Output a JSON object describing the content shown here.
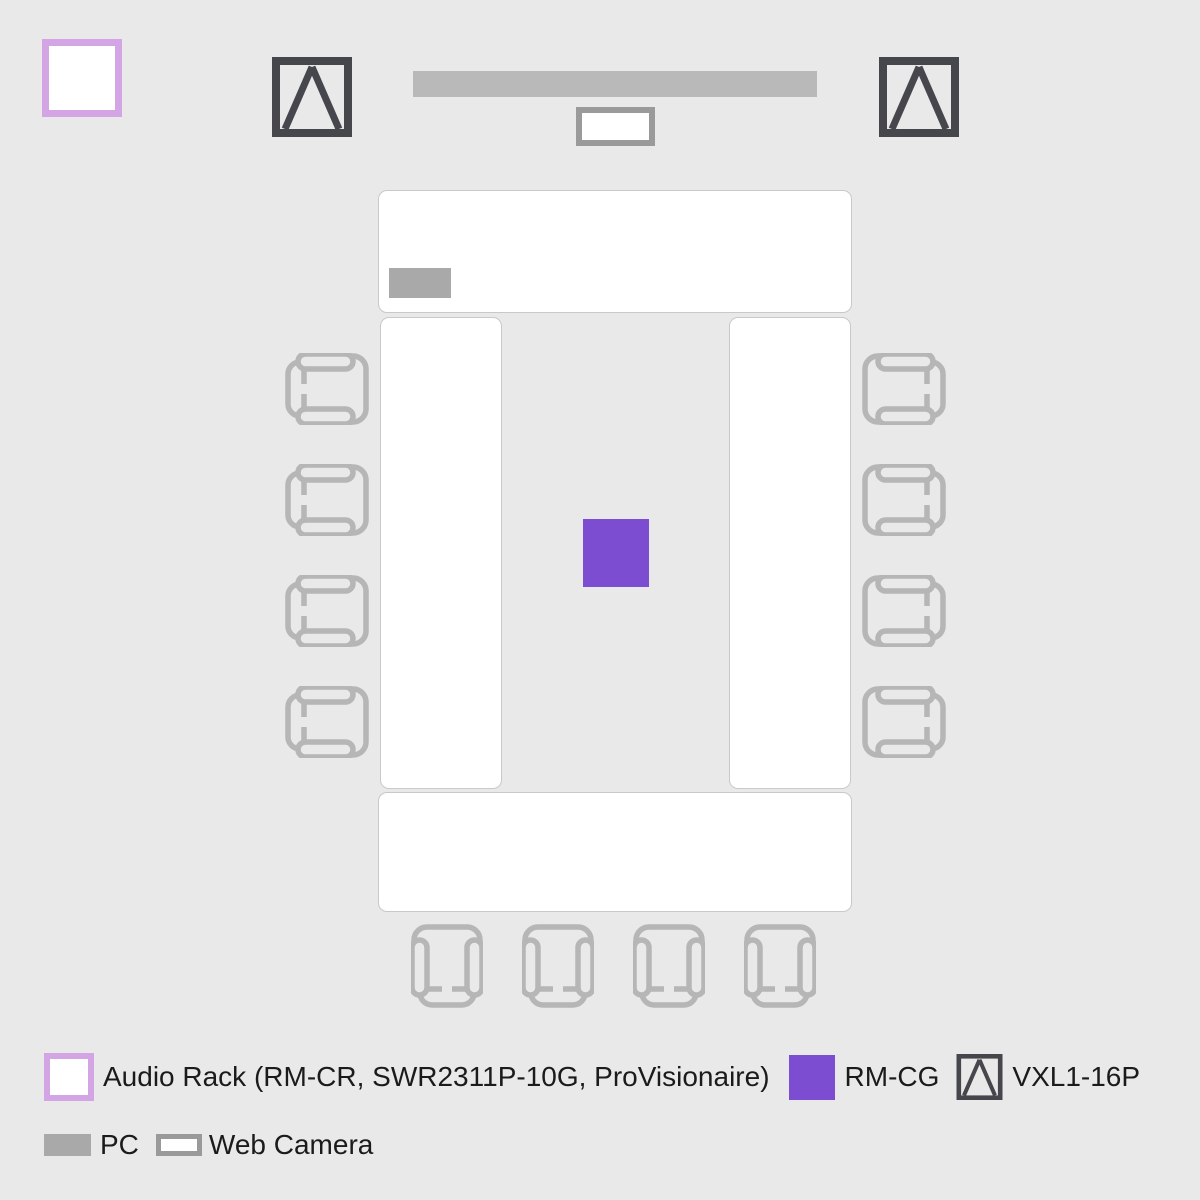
{
  "legend": {
    "audio_rack": "Audio Rack (RM-CR, SWR2311P-10G, ProVisionaire)",
    "rm_cg": "RM-CG",
    "vxl": "VXL1-16P",
    "pc": "PC",
    "web_camera": "Web Camera"
  },
  "colors": {
    "background": "#e9e9e9",
    "table_fill": "#ffffff",
    "table_border": "#c9c9c9",
    "chair_stroke": "#b6b6b6",
    "display_bar": "#b9b9b9",
    "pc_fill": "#a9a9a9",
    "web_camera_border": "#9a9a9a",
    "rm_cg_purple": "#7c4dd1",
    "audio_rack_border": "#d4a5e5",
    "vxl_dark": "#45474c",
    "legend_text": "#1b1b1b"
  },
  "floor_plan": {
    "tables": 4,
    "chairs_left": 4,
    "chairs_right": 4,
    "chairs_bottom": 4,
    "speakers": 2
  }
}
